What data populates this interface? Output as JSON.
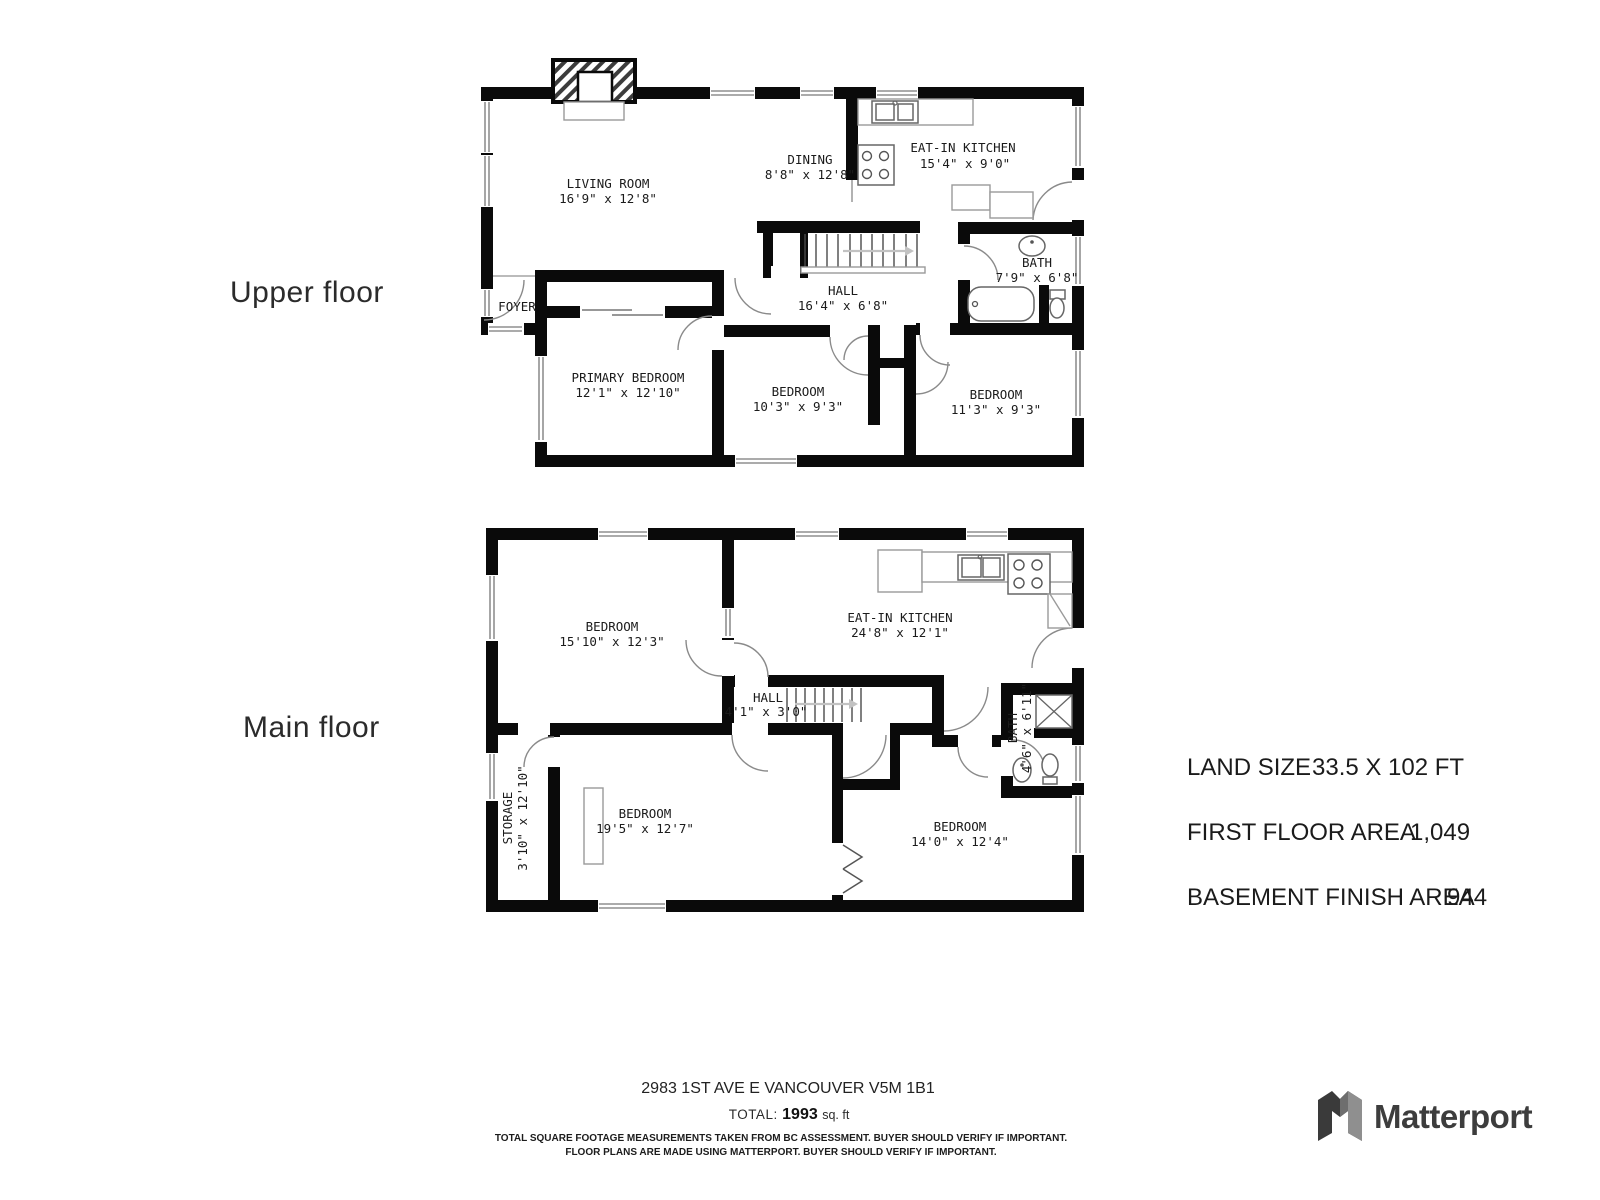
{
  "colors": {
    "wall": "#0a0a0a",
    "label_text": "#1b1b1b",
    "logo_text": "#3d3d3d"
  },
  "floors": [
    {
      "label": "Upper floor",
      "rooms": [
        {
          "name": "LIVING ROOM",
          "dims": "16'9\" x 12'8\""
        },
        {
          "name": "DINING",
          "dims": "8'8\" x 12'8\""
        },
        {
          "name": "EAT-IN KITCHEN",
          "dims": "15'4\" x 9'0\""
        },
        {
          "name": "BATH",
          "dims": "7'9\" x 6'8\""
        },
        {
          "name": "HALL",
          "dims": "16'4\" x 6'8\""
        },
        {
          "name": "FOYER",
          "dims": ""
        },
        {
          "name": "PRIMARY BEDROOM",
          "dims": "12'1\" x 12'10\""
        },
        {
          "name": "BEDROOM",
          "dims": "10'3\" x 9'3\""
        },
        {
          "name": "BEDROOM",
          "dims": "11'3\" x 9'3\""
        }
      ]
    },
    {
      "label": "Main floor",
      "rooms": [
        {
          "name": "BEDROOM",
          "dims": "15'10\" x 12'3\""
        },
        {
          "name": "EAT-IN KITCHEN",
          "dims": "24'8\" x 12'1\""
        },
        {
          "name": "HALL",
          "dims": "4'1\" x 3'0\""
        },
        {
          "name": "STORAGE",
          "dims": "3'10\" x 12'10\""
        },
        {
          "name": "BATH",
          "dims": "4'6\" x 6'11\""
        },
        {
          "name": "BEDROOM",
          "dims": "19'5\" x 12'7\""
        },
        {
          "name": "BEDROOM",
          "dims": "14'0\" x 12'4\""
        }
      ]
    }
  ],
  "info": {
    "rows": [
      {
        "label": "LAND SIZE",
        "value": "33.5 X 102 FT"
      },
      {
        "label": "FIRST FLOOR AREA",
        "value": "1,049"
      },
      {
        "label": "BASEMENT FINISH AREA",
        "value": "944"
      }
    ]
  },
  "footer": {
    "address": "2983 1ST AVE E VANCOUVER V5M 1B1",
    "total_label": "TOTAL:",
    "total_value": "1993",
    "total_unit": "sq. ft",
    "disclaimer1": "TOTAL SQUARE FOOTAGE MEASUREMENTS TAKEN FROM BC ASSESSMENT. BUYER SHOULD VERIFY IF IMPORTANT.",
    "disclaimer2": "FLOOR PLANS ARE MADE USING MATTERPORT. BUYER SHOULD VERIFY IF IMPORTANT."
  },
  "logo": {
    "wordmark": "Matterport"
  }
}
